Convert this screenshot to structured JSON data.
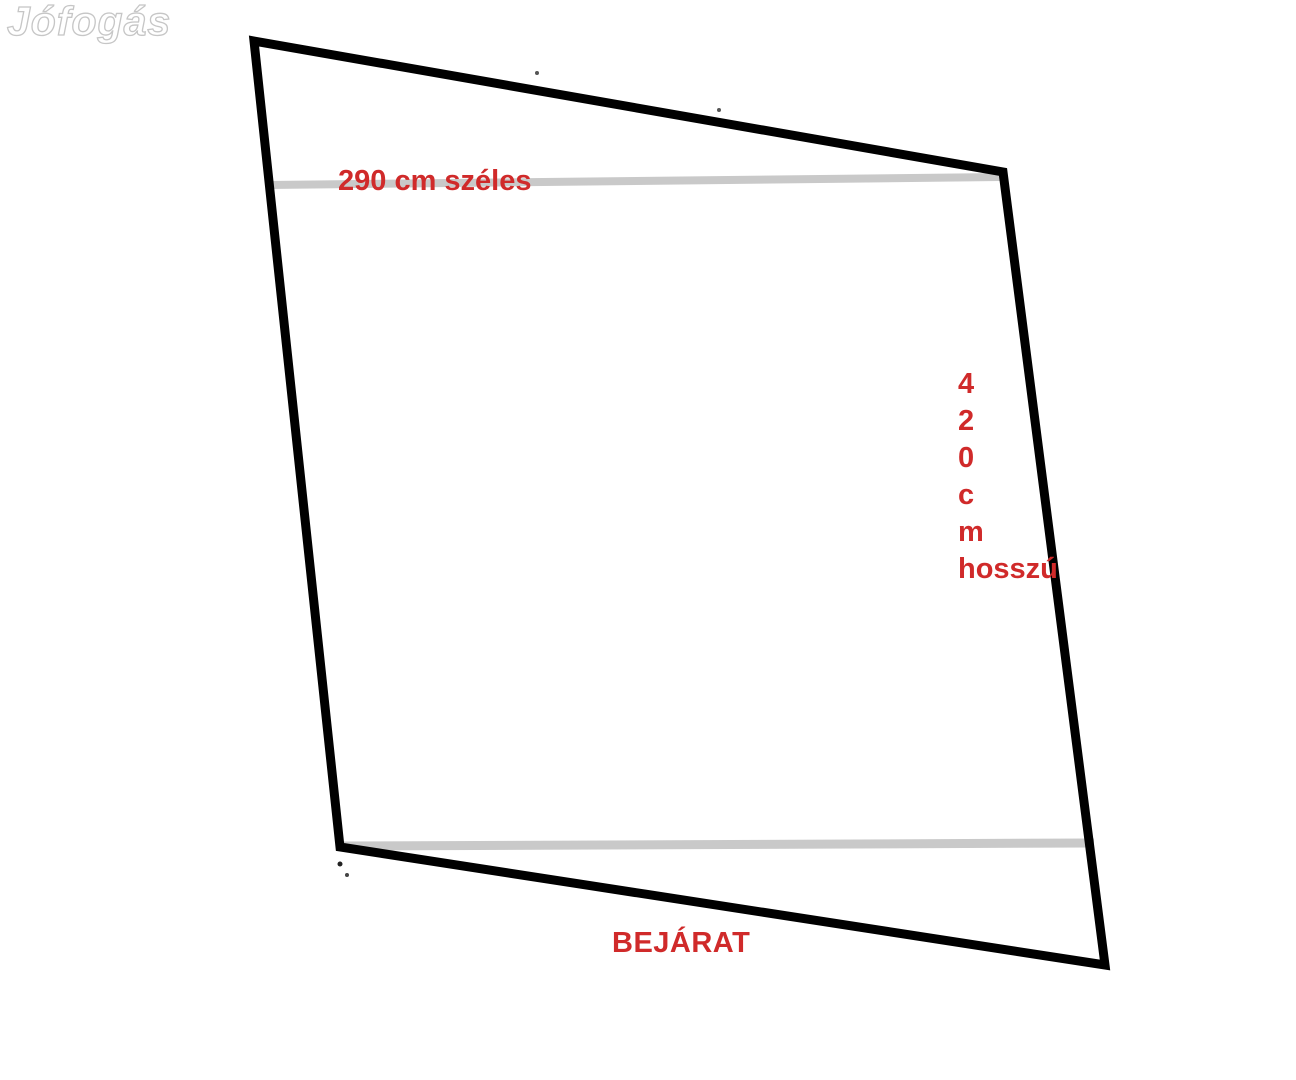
{
  "watermark": {
    "text": "Jófogás"
  },
  "labels": {
    "width": "290 cm széles",
    "length_chars": [
      "4",
      "2",
      "0",
      "c",
      "m"
    ],
    "length_word": "hosszú",
    "entrance": "BEJÁRAT"
  },
  "colors": {
    "dimension_text": "#d02a2a",
    "outline": "#000000",
    "measure_line": "#c9c9c9",
    "watermark_outline": "#c6c6c6",
    "background": "#ffffff"
  }
}
